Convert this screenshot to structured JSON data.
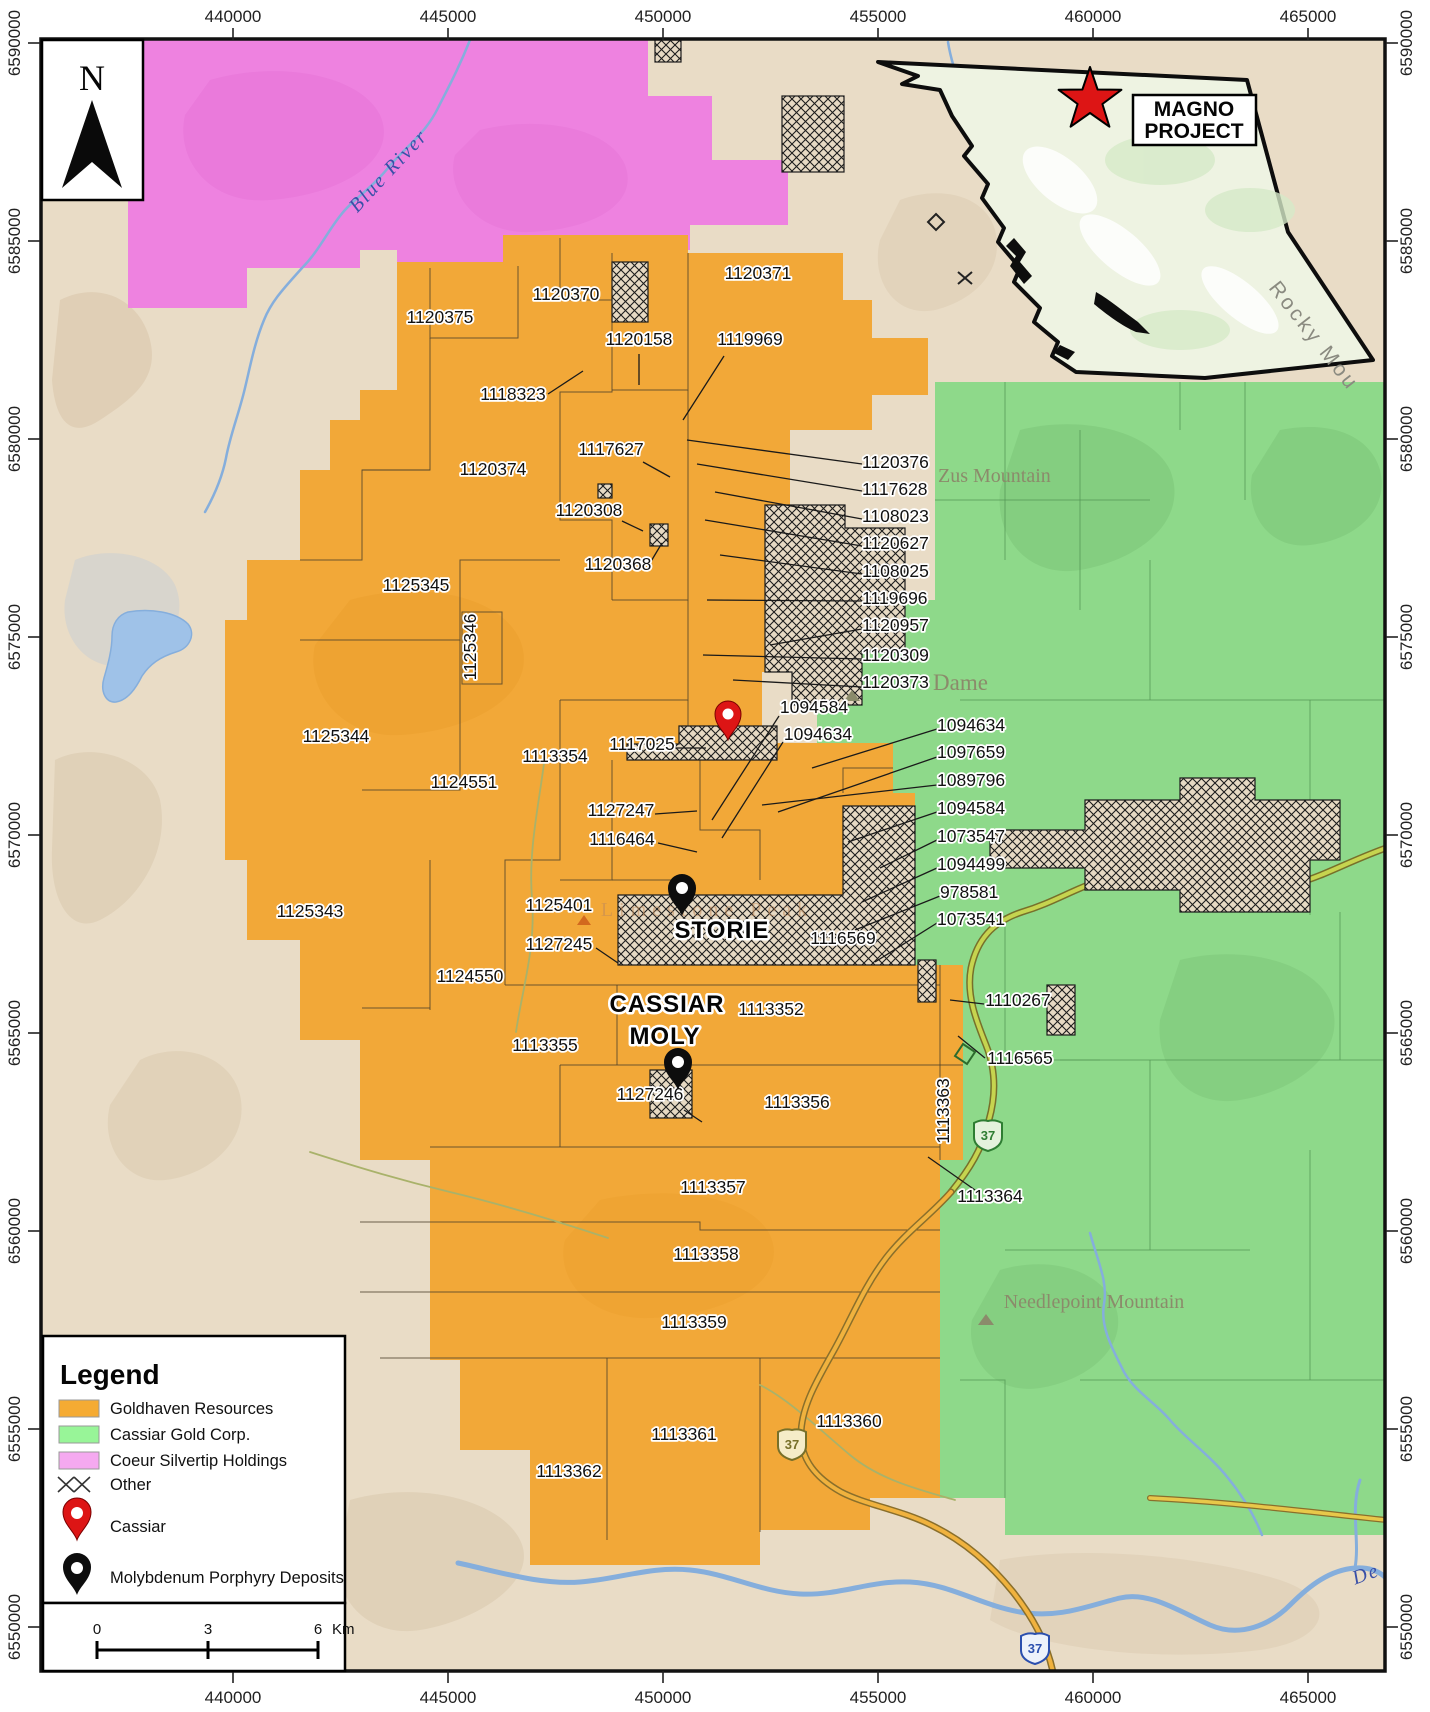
{
  "north_label": "N",
  "inset": {
    "project_line1": "MAGNO",
    "project_line2": "PROJECT",
    "region_label": "Rocky Mou"
  },
  "axes": {
    "top": [
      {
        "t": "440000",
        "x": 233
      },
      {
        "t": "445000",
        "x": 448
      },
      {
        "t": "450000",
        "x": 663
      },
      {
        "t": "455000",
        "x": 878
      },
      {
        "t": "460000",
        "x": 1093
      },
      {
        "t": "465000",
        "x": 1308
      }
    ],
    "bottom": [
      {
        "t": "440000",
        "x": 233
      },
      {
        "t": "445000",
        "x": 448
      },
      {
        "t": "450000",
        "x": 663
      },
      {
        "t": "455000",
        "x": 878
      },
      {
        "t": "460000",
        "x": 1093
      },
      {
        "t": "465000",
        "x": 1308
      }
    ],
    "left": [
      {
        "t": "6590000",
        "y": 43
      },
      {
        "t": "6585000",
        "y": 241
      },
      {
        "t": "6580000",
        "y": 439
      },
      {
        "t": "6575000",
        "y": 637
      },
      {
        "t": "6570000",
        "y": 835
      },
      {
        "t": "6565000",
        "y": 1033
      },
      {
        "t": "6560000",
        "y": 1231
      },
      {
        "t": "6555000",
        "y": 1429
      },
      {
        "t": "6550000",
        "y": 1627
      }
    ],
    "right": [
      {
        "t": "6590000",
        "y": 43
      },
      {
        "t": "6585000",
        "y": 241
      },
      {
        "t": "6580000",
        "y": 439
      },
      {
        "t": "6575000",
        "y": 637
      },
      {
        "t": "6570000",
        "y": 835
      },
      {
        "t": "6565000",
        "y": 1033
      },
      {
        "t": "6560000",
        "y": 1231
      },
      {
        "t": "6555000",
        "y": 1429
      },
      {
        "t": "6550000",
        "y": 1627
      }
    ]
  },
  "legend": {
    "title": "Legend",
    "goldhaven": "Goldhaven Resources",
    "cassiar_gold": "Cassiar Gold Corp.",
    "coeur": "Coeur Silvertip Holdings",
    "other": "Other",
    "cassiar": "Cassiar",
    "moly": "Molybdenum Porphyry Deposits"
  },
  "scalebar": {
    "zero": "0",
    "three": "3",
    "six": "6",
    "unit": "Km"
  },
  "map": {
    "shield_label": "37",
    "colors": {
      "goldhaven": "#F2A838",
      "cassiar_gold": "#8ED98A",
      "coeur": "#EE82E0",
      "legend_goldhaven": "#F5AB33",
      "legend_green": "#98F598",
      "legend_pink": "#F5A9F0",
      "basemap_tan": "#E9DCC6",
      "water": "#85AEDC",
      "hatch_bg": "#E6D9C3",
      "highway_north": "#C6D44F",
      "highway_south": "#F0B23E",
      "pin_red": "#DD1515",
      "pin_black": "#0d0d0d"
    },
    "labels": [
      {
        "t": "1120375",
        "x": 440,
        "y": 323
      },
      {
        "t": "1120370",
        "x": 566,
        "y": 300
      },
      {
        "t": "1120371",
        "x": 758,
        "y": 279
      },
      {
        "t": "1120158",
        "x": 639,
        "y": 345
      },
      {
        "t": "1119969",
        "x": 750,
        "y": 345
      },
      {
        "t": "1118323",
        "x": 513,
        "y": 400
      },
      {
        "t": "1117627",
        "x": 611,
        "y": 455
      },
      {
        "t": "1120374",
        "x": 493,
        "y": 475
      },
      {
        "t": "1120308",
        "x": 589,
        "y": 516
      },
      {
        "t": "1120368",
        "x": 618,
        "y": 570
      },
      {
        "t": "1125345",
        "x": 416,
        "y": 591
      },
      {
        "t": "1125346",
        "x": 476,
        "y": 647,
        "r": -90
      },
      {
        "t": "1125344",
        "x": 336,
        "y": 742
      },
      {
        "t": "1124551",
        "x": 464,
        "y": 788
      },
      {
        "t": "1125343",
        "x": 310,
        "y": 917
      },
      {
        "t": "1124550",
        "x": 470,
        "y": 982
      },
      {
        "t": "1113354",
        "x": 555,
        "y": 762
      },
      {
        "t": "1117025",
        "x": 642,
        "y": 750
      },
      {
        "t": "1127247",
        "x": 621,
        "y": 816
      },
      {
        "t": "1116464",
        "x": 622,
        "y": 845
      },
      {
        "t": "1125401",
        "x": 559,
        "y": 911
      },
      {
        "t": "1127245",
        "x": 559,
        "y": 950
      },
      {
        "t": "1113355",
        "x": 545,
        "y": 1051
      },
      {
        "t": "1113352",
        "x": 771,
        "y": 1015
      },
      {
        "t": "1116569",
        "x": 843,
        "y": 944
      },
      {
        "t": "1127246",
        "x": 650,
        "y": 1100
      },
      {
        "t": "1113356",
        "x": 797,
        "y": 1108
      },
      {
        "t": "1113357",
        "x": 713,
        "y": 1193
      },
      {
        "t": "1113358",
        "x": 706,
        "y": 1260
      },
      {
        "t": "1113359",
        "x": 694,
        "y": 1328
      },
      {
        "t": "1113361",
        "x": 684,
        "y": 1440
      },
      {
        "t": "1113360",
        "x": 849,
        "y": 1427
      },
      {
        "t": "1113362",
        "x": 569,
        "y": 1477
      },
      {
        "t": "1113363",
        "x": 949,
        "y": 1111,
        "r": -90
      },
      {
        "t": "1110267",
        "x": 1018,
        "y": 1006
      },
      {
        "t": "1116565",
        "x": 1020,
        "y": 1064
      },
      {
        "t": "1113364",
        "x": 990,
        "y": 1202
      },
      {
        "t": "1120376",
        "x": 862,
        "y": 468,
        "a": "s"
      },
      {
        "t": "1117628",
        "x": 862,
        "y": 495,
        "a": "s"
      },
      {
        "t": "1108023",
        "x": 862,
        "y": 522,
        "a": "s"
      },
      {
        "t": "1120627",
        "x": 862,
        "y": 549,
        "a": "s"
      },
      {
        "t": "1108025",
        "x": 862,
        "y": 577,
        "a": "s"
      },
      {
        "t": "1119696",
        "x": 862,
        "y": 604,
        "a": "s"
      },
      {
        "t": "1120957",
        "x": 862,
        "y": 631,
        "a": "s"
      },
      {
        "t": "1120309",
        "x": 862,
        "y": 661,
        "a": "s"
      },
      {
        "t": "1120373",
        "x": 862,
        "y": 688,
        "a": "s"
      },
      {
        "t": "1094584",
        "x": 814,
        "y": 713
      },
      {
        "t": "1094634",
        "x": 818,
        "y": 740
      },
      {
        "t": "1094634",
        "x": 937,
        "y": 731,
        "a": "s"
      },
      {
        "t": "1097659",
        "x": 937,
        "y": 758,
        "a": "s"
      },
      {
        "t": "1089796",
        "x": 937,
        "y": 786,
        "a": "s"
      },
      {
        "t": "1094584",
        "x": 937,
        "y": 814,
        "a": "s"
      },
      {
        "t": "1073547",
        "x": 937,
        "y": 842,
        "a": "s"
      },
      {
        "t": "1094499",
        "x": 937,
        "y": 870,
        "a": "s"
      },
      {
        "t": "978581",
        "x": 940,
        "y": 898,
        "a": "s"
      },
      {
        "t": "1073541",
        "x": 937,
        "y": 925,
        "a": "s"
      },
      {
        "t": "STORIE",
        "x": 722,
        "y": 938,
        "k": "d"
      },
      {
        "t": "CASSIAR",
        "x": 667,
        "y": 1012,
        "k": "d"
      },
      {
        "t": "MOLY",
        "x": 665,
        "y": 1044,
        "k": "d"
      },
      {
        "t": "Zus Mountain",
        "x": 938,
        "y": 482,
        "a": "s",
        "k": "p"
      },
      {
        "t": "Dame",
        "x": 933,
        "y": 690,
        "a": "s",
        "k": "p2"
      },
      {
        "t": "Needlepoint Mountain",
        "x": 1094,
        "y": 1308,
        "k": "p"
      },
      {
        "t": "Limestone Peak",
        "x": 707,
        "y": 916,
        "k": "lp"
      },
      {
        "t": "Rocky Mou",
        "x": 1268,
        "y": 288,
        "r": 52,
        "k": "rm",
        "a": "s"
      },
      {
        "t": "Blue River",
        "x": 393,
        "y": 175,
        "r": -47,
        "k": "w"
      },
      {
        "t": "De",
        "x": 1368,
        "y": 1580,
        "r": -20,
        "k": "w"
      }
    ],
    "leaders": [
      [
        862,
        464,
        687,
        440
      ],
      [
        862,
        491,
        697,
        464
      ],
      [
        862,
        519,
        715,
        492
      ],
      [
        862,
        546,
        705,
        520
      ],
      [
        862,
        574,
        720,
        555
      ],
      [
        862,
        601,
        707,
        600
      ],
      [
        862,
        629,
        770,
        645
      ],
      [
        862,
        659,
        703,
        655
      ],
      [
        862,
        687,
        733,
        680
      ],
      [
        937,
        729,
        812,
        768
      ],
      [
        937,
        757,
        778,
        812
      ],
      [
        937,
        785,
        762,
        805
      ],
      [
        937,
        812,
        848,
        842
      ],
      [
        937,
        840,
        880,
        868
      ],
      [
        937,
        868,
        862,
        902
      ],
      [
        940,
        896,
        855,
        930
      ],
      [
        937,
        923,
        875,
        962
      ],
      [
        779,
        716,
        712,
        820
      ],
      [
        783,
        742,
        722,
        838
      ],
      [
        672,
        748,
        706,
        748
      ],
      [
        655,
        814,
        697,
        811
      ],
      [
        658,
        843,
        697,
        852
      ],
      [
        724,
        356,
        683,
        420
      ],
      [
        548,
        394,
        583,
        371
      ],
      [
        643,
        462,
        670,
        477
      ],
      [
        639,
        354,
        639,
        385
      ],
      [
        622,
        521,
        643,
        531
      ],
      [
        650,
        563,
        662,
        543
      ],
      [
        984,
        1004,
        950,
        1000
      ],
      [
        985,
        1058,
        958,
        1036
      ],
      [
        975,
        1190,
        928,
        1157
      ],
      [
        684,
        1110,
        702,
        1122
      ],
      [
        596,
        948,
        618,
        963
      ]
    ]
  }
}
